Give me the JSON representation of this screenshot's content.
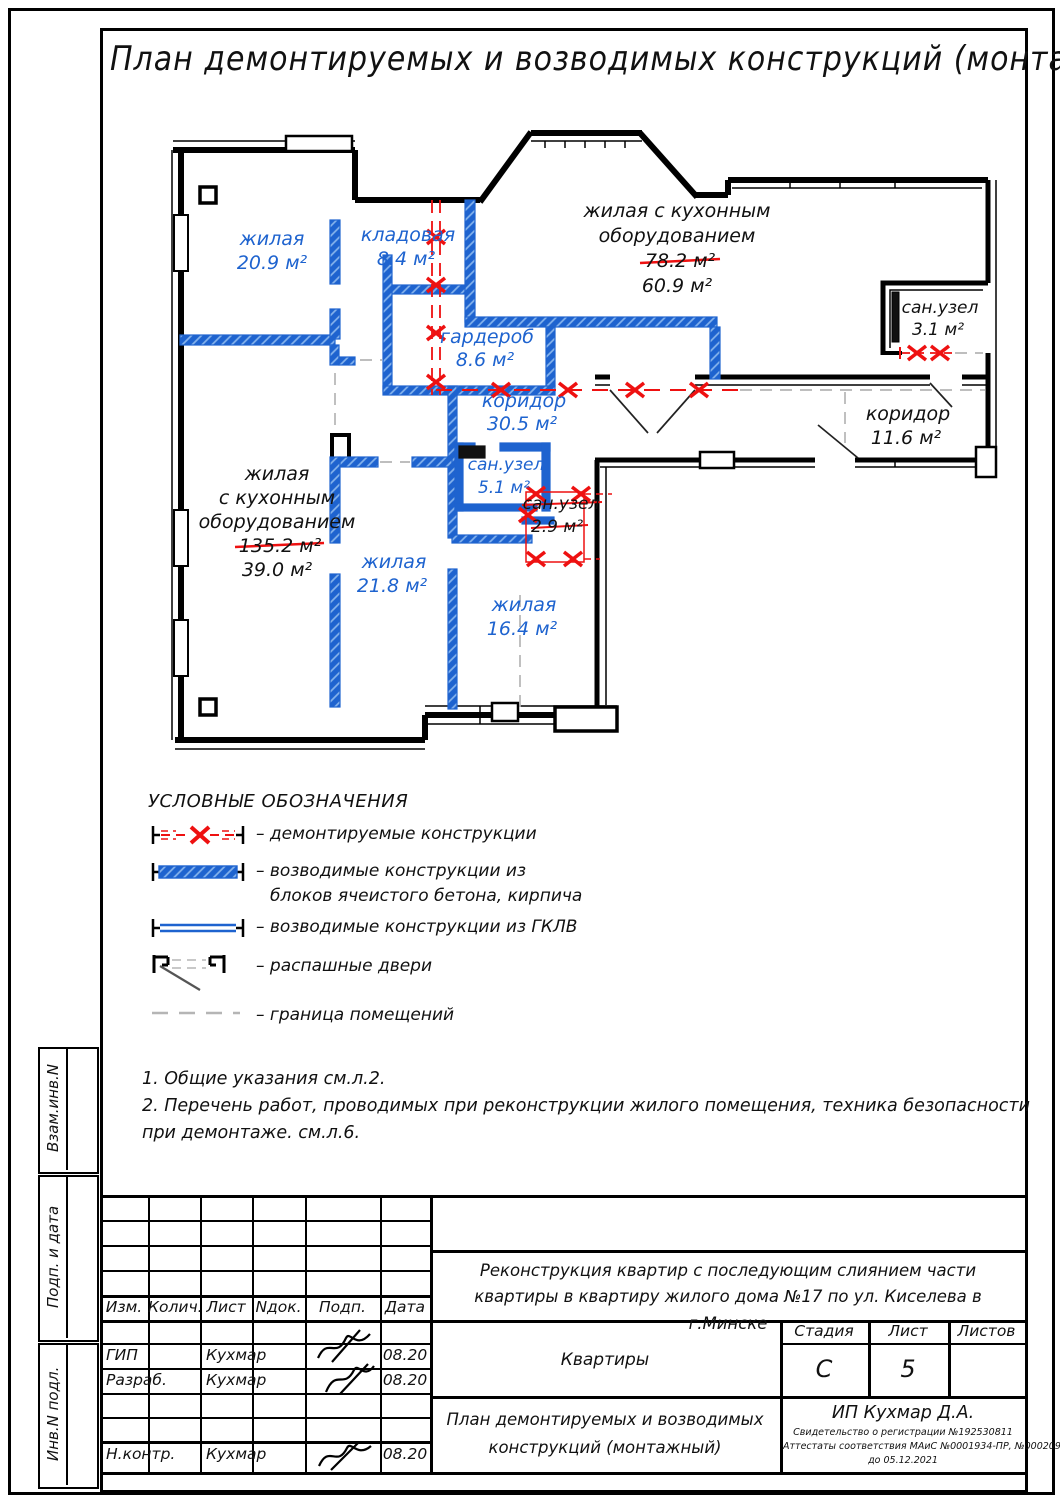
{
  "title": "План демонтируемых и возводимых конструкций (монтажный)",
  "colors": {
    "new_wall_blue": "#1e63cf",
    "demolition_red": "#ee1111",
    "boundary_gray": "#b5b5b5"
  },
  "plan": {
    "rooms": {
      "r1": {
        "name": "жилая",
        "area": "20.9 м²"
      },
      "r2": {
        "name": "кладовая",
        "area": "8.4 м²"
      },
      "r3": {
        "l1": "жилая с кухонным",
        "l2": "оборудованием",
        "old": "78.2 м²",
        "new": "60.9 м²"
      },
      "r4": {
        "name": "сан.узел",
        "area": "3.1 м²"
      },
      "r5": {
        "name": "гардероб",
        "area": "8.6 м²"
      },
      "r6": {
        "name": "коридор",
        "area": "30.5 м²"
      },
      "r7": {
        "name": "коридор",
        "area": "11.6 м²"
      },
      "r8": {
        "l1": "жилая",
        "l2": "с кухонным",
        "l3": "оборудованием",
        "old": "135.2 м²",
        "new": "39.0 м²"
      },
      "r9": {
        "name": "сан.узел",
        "area": "5.1 м²"
      },
      "r10": {
        "name": "сан.узел",
        "area": "2.9 м²"
      },
      "r11": {
        "name": "жилая",
        "area": "21.8 м²"
      },
      "r12": {
        "name": "жилая",
        "area": "16.4 м²"
      }
    }
  },
  "legend": {
    "heading": "УСЛОВНЫЕ ОБОЗНАЧЕНИЯ",
    "demolished": "– демонтируемые конструкции",
    "erected_blocks_1": "– возводимые конструкции из",
    "erected_blocks_2": "блоков ячеистого бетона, кирпича",
    "erected_gklv": "– возводимые конструкции из ГКЛВ",
    "doors": "– распашные двери",
    "boundary": "– граница помещений"
  },
  "notes": {
    "line1": "1. Общие указания см.л.2.",
    "line2": "2. Перечень работ, проводимых при реконструкции жилого помещения, техника безопасности при демонтаже. см.л.6."
  },
  "titleblock": {
    "rev_headers": [
      "Изм.",
      "Колич.",
      "Лист",
      "Nдок.",
      "Подп.",
      "Дата"
    ],
    "staff": [
      {
        "role": "ГИП",
        "name": "Кухмар",
        "date": "08.20"
      },
      {
        "role": "Разраб.",
        "name": "Кухмар",
        "date": "08.20"
      },
      {
        "role": "Н.контр.",
        "name": "Кухмар",
        "date": "08.20"
      }
    ],
    "project": "Реконструкция квартир с последующим слиянием части квартиры в квартиру жилого дома  №17  по ул. Киселева в г.Минске",
    "object": "Квартиры",
    "stage_label": "Стадия",
    "sheet_label": "Лист",
    "sheets_label": "Листов",
    "stage": "С",
    "sheet": "5",
    "drawing_title_1": "План демонтируемых и возводимых",
    "drawing_title_2": "конструкций (монтажный)",
    "company": "ИП Кухмар Д.А.",
    "cert1": "Свидетельство о регистрации №192530811",
    "cert2": "Аттестаты соответствия МАиС  №0001934-ПР,  №0002091-ПР",
    "cert3": "до 05.12.2021"
  },
  "sidebar": {
    "c1": "Взам.инв.N",
    "c2": "Подп. и дата",
    "c3": "Инв.N подл."
  }
}
